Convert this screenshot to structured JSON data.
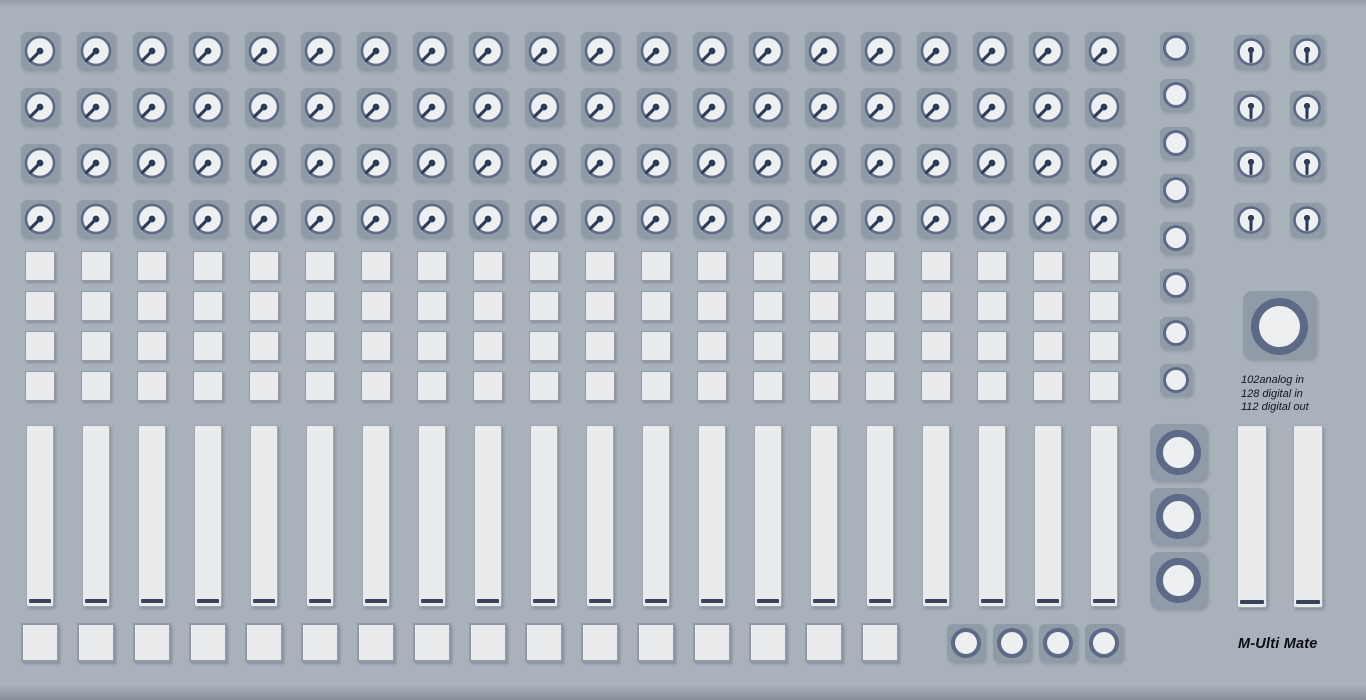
{
  "device": {
    "brand_label": "M-Ulti Mate",
    "io_info": {
      "lines": [
        "102analog in",
        "128 digital in",
        "112 digital out"
      ]
    }
  },
  "sections": {
    "encoder_grid": {
      "rows": 4,
      "columns": 20,
      "control": "rotary-knob"
    },
    "button_grid": {
      "rows": 4,
      "columns": 20,
      "control": "square-button"
    },
    "channel_faders": {
      "count": 20,
      "control": "vertical-fader"
    },
    "bottom_buttons": {
      "count": 16,
      "control": "square-button"
    },
    "transport_buttons": {
      "count": 4,
      "control": "round-button"
    },
    "right_buttons": {
      "count": 8,
      "control": "round-button"
    },
    "master_encoders": {
      "rows": 4,
      "columns": 2,
      "control": "rotary-knob"
    },
    "jog_wheel": {
      "count": 1,
      "control": "large-encoder"
    },
    "big_buttons": {
      "count": 3,
      "control": "large-round-button"
    },
    "master_faders": {
      "count": 2,
      "control": "vertical-fader"
    }
  },
  "icons": {
    "knob_indicator": "dot-with-pointer-line"
  },
  "colors": {
    "bg": "#a9b1ba",
    "panel": "#909ba8",
    "fill": "#edeff1",
    "ring": "#5c6a87",
    "pointer": "#2d3b59",
    "button": "#e9ebec",
    "handle": "#39445c",
    "ink": "#12161e"
  }
}
